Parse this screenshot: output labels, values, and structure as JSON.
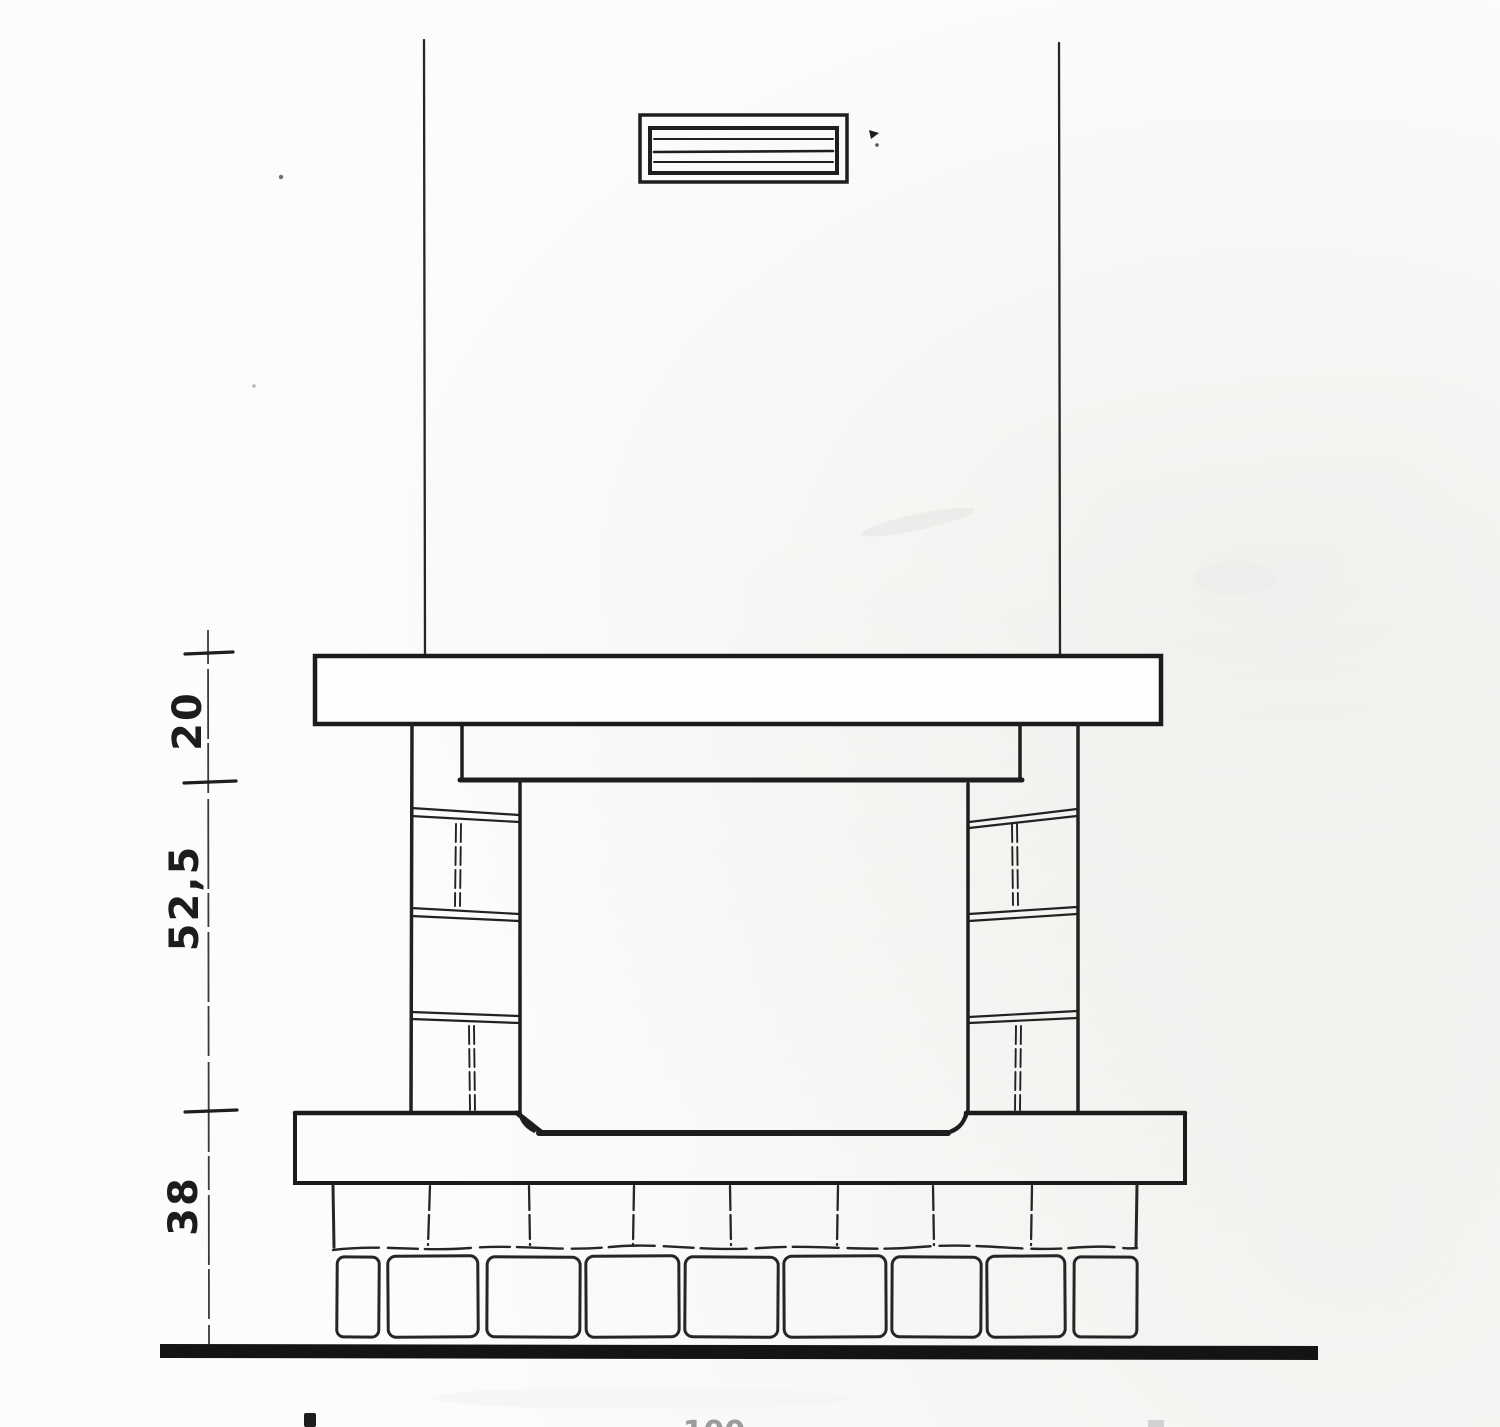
{
  "drawing": {
    "dimension_labels": {
      "mantel_zone": "20",
      "opening_zone": "52,5",
      "base_zone": "38"
    },
    "bottom_cropped_label": "100",
    "colors": {
      "paper": "#fcfcfb",
      "ink": "#1e1e1e",
      "ground_bar": "#141414",
      "faint_gray": "#9b9b9b"
    }
  }
}
